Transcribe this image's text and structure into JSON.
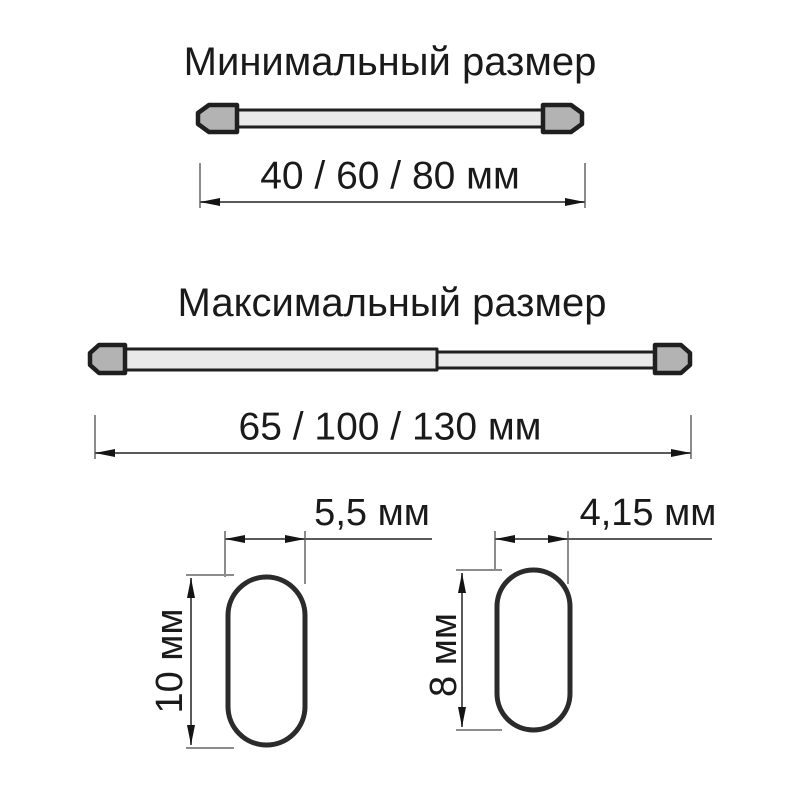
{
  "diagram": {
    "min_section": {
      "title": "Минимальный размер",
      "length_label": "40 / 60 / 80 мм"
    },
    "max_section": {
      "title": "Максимальный размер",
      "length_label": "65 / 100 / 130 мм"
    },
    "cross_sections": [
      {
        "width_label": "5,5 мм",
        "height_label": "10 мм"
      },
      {
        "width_label": "4,15 мм",
        "height_label": "8 мм"
      }
    ],
    "units": "мм",
    "colors": {
      "background": "#ffffff",
      "rod_outline": "#1f1f1f",
      "cap_fill": "#b3b3b3",
      "tube_fill": "#e9e9e9",
      "oval_stroke": "#2b2b2b",
      "dimension_line": "#5a5a5a",
      "extension_line": "#8c8c8c",
      "arrow": "#141414",
      "text": "#1a1a1a"
    }
  }
}
